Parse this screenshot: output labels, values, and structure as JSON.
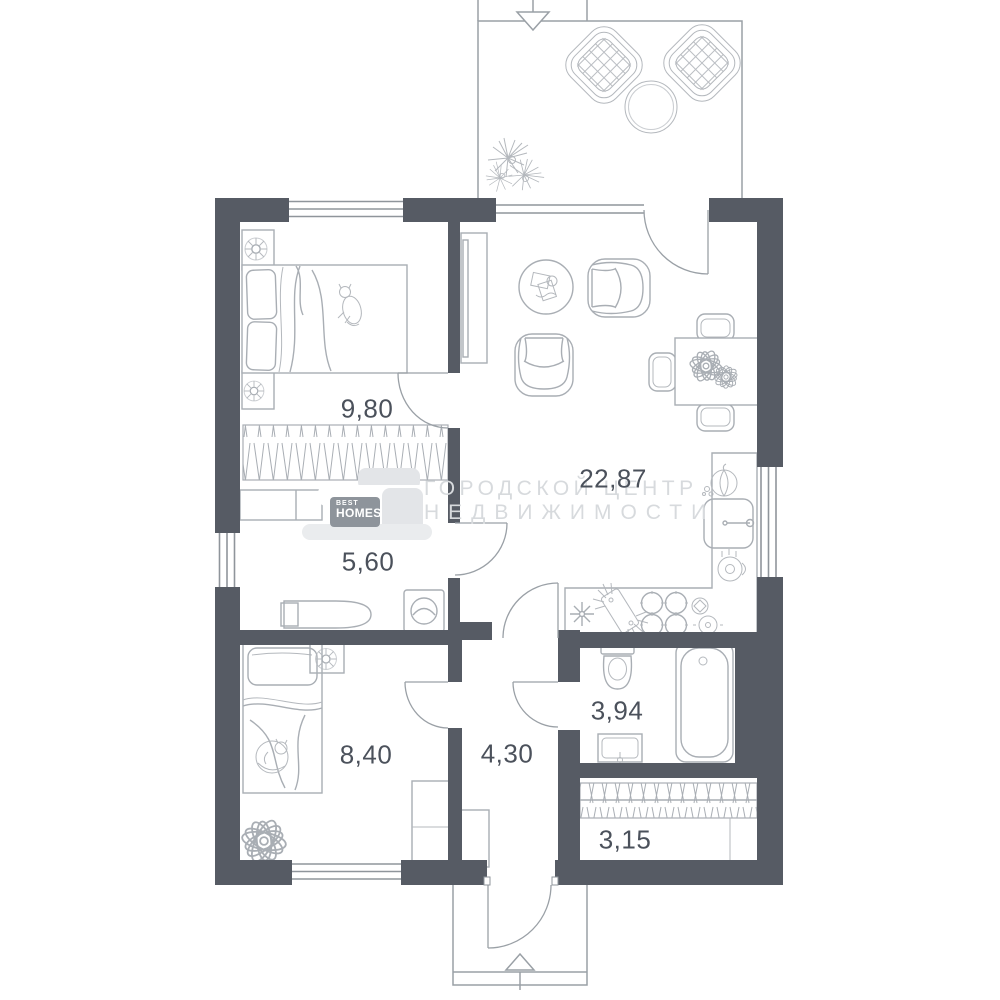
{
  "plan": {
    "title": "one-storey house floor plan",
    "rooms": [
      {
        "name": "bedroom-1",
        "area": "9,80"
      },
      {
        "name": "living-kitchen",
        "area": "22,87"
      },
      {
        "name": "hall-laundry",
        "area": "5,60"
      },
      {
        "name": "bedroom-2",
        "area": "8,40"
      },
      {
        "name": "hallway",
        "area": "4,30"
      },
      {
        "name": "bathroom",
        "area": "3,94"
      },
      {
        "name": "entry-closet",
        "area": "3,15"
      }
    ],
    "icons": [
      "entrance-arrow-top-icon",
      "entrance-arrow-bottom-icon",
      "wardrobe-hatch",
      "door-swing-arc"
    ]
  },
  "watermark": {
    "logo_top": "BEST",
    "logo_name": "HOMES",
    "line1": "ГОРОДСКОЙ ЦЕНТР",
    "line2": "НЕДВИЖИМОСТИ"
  },
  "colors": {
    "wall": "#565b64",
    "furniture_line": "#a9aeb4",
    "outline": "#9aa0a6",
    "label": "#4b515b",
    "watermark_text": "#d7dadd",
    "logo_bg": "#8e949b"
  }
}
